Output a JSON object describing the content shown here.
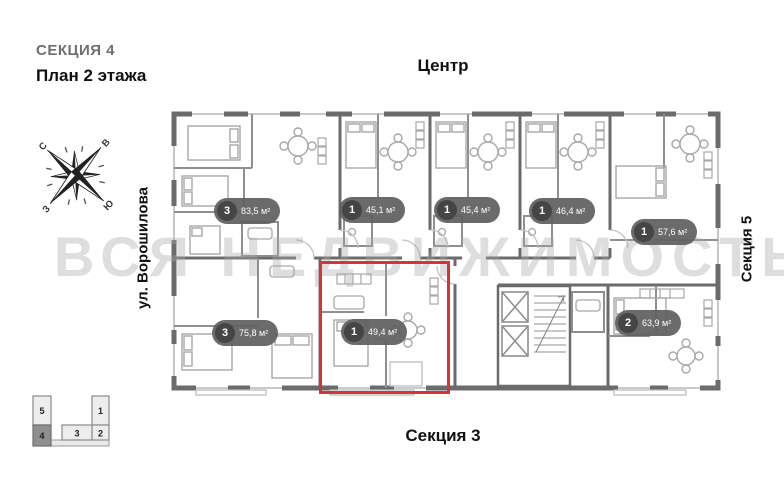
{
  "header": {
    "section_title": "СЕКЦИЯ 4",
    "plan_title": "План 2 этажа"
  },
  "directions": {
    "top": "Центр",
    "bottom": "Секция 3",
    "left": "ул. Ворошилова",
    "right": "Секция 5"
  },
  "compass": {
    "n": "С",
    "e": "В",
    "s": "Ю",
    "w": "З"
  },
  "watermark": "ВСЯ НЕДВИЖИМОСТЬ",
  "apartments": [
    {
      "rooms": "3",
      "area": "83,5 м²"
    },
    {
      "rooms": "1",
      "area": "45,1 м²"
    },
    {
      "rooms": "1",
      "area": "45,4 м²"
    },
    {
      "rooms": "1",
      "area": "46,4 м²"
    },
    {
      "rooms": "1",
      "area": "57,6 м²"
    },
    {
      "rooms": "3",
      "area": "75,8 м²"
    },
    {
      "rooms": "1",
      "area": "49,4 м²",
      "highlighted": true
    },
    {
      "rooms": "2",
      "area": "63,9 м²"
    }
  ],
  "minimap": {
    "sections": [
      {
        "label": "5"
      },
      {
        "label": "4",
        "active": true
      },
      {
        "label": "1"
      },
      {
        "label": "2"
      },
      {
        "label": "3"
      }
    ]
  },
  "colors": {
    "highlight_red": "#d93434",
    "badge_bg": "#606060",
    "badge_circle": "#454545",
    "wall_gray": "#6b6b6b",
    "active_section_gray": "#8f8f8f"
  }
}
